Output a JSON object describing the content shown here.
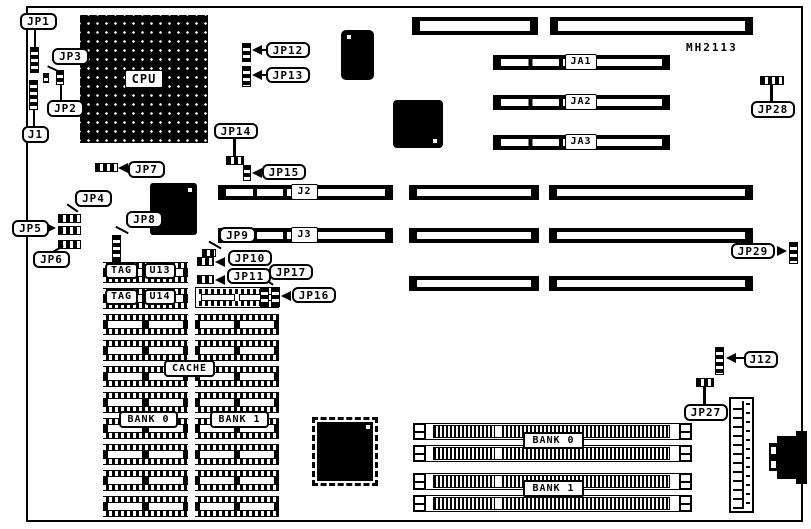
{
  "board": {
    "model": "MH2113"
  },
  "jumpers": {
    "jp1": "JP1",
    "jp2": "JP2",
    "jp3": "JP3",
    "jp4": "JP4",
    "jp5": "JP5",
    "jp6": "JP6",
    "jp7": "JP7",
    "jp8": "JP8",
    "jp9": "JP9",
    "jp10": "JP10",
    "jp11": "JP11",
    "jp12": "JP12",
    "jp13": "JP13",
    "jp14": "JP14",
    "jp15": "JP15",
    "jp16": "JP16",
    "jp17": "JP17",
    "jp27": "JP27",
    "jp28": "JP28",
    "jp29": "JP29"
  },
  "connectors": {
    "j1": "J1",
    "j12": "J12"
  },
  "slots": {
    "j2": "J2",
    "j3": "J3",
    "ja1": "JA1",
    "ja2": "JA2",
    "ja3": "JA3"
  },
  "chips": {
    "cpu": "CPU",
    "tag": "TAG",
    "u13": "U13",
    "u14": "U14",
    "cache": "CACHE",
    "cache_bank0": "BANK 0",
    "cache_bank1": "BANK 1"
  },
  "memory": {
    "bank0": "BANK 0",
    "bank1": "BANK 1"
  },
  "colors": {
    "ink": "#000000",
    "paper": "#ffffff"
  }
}
